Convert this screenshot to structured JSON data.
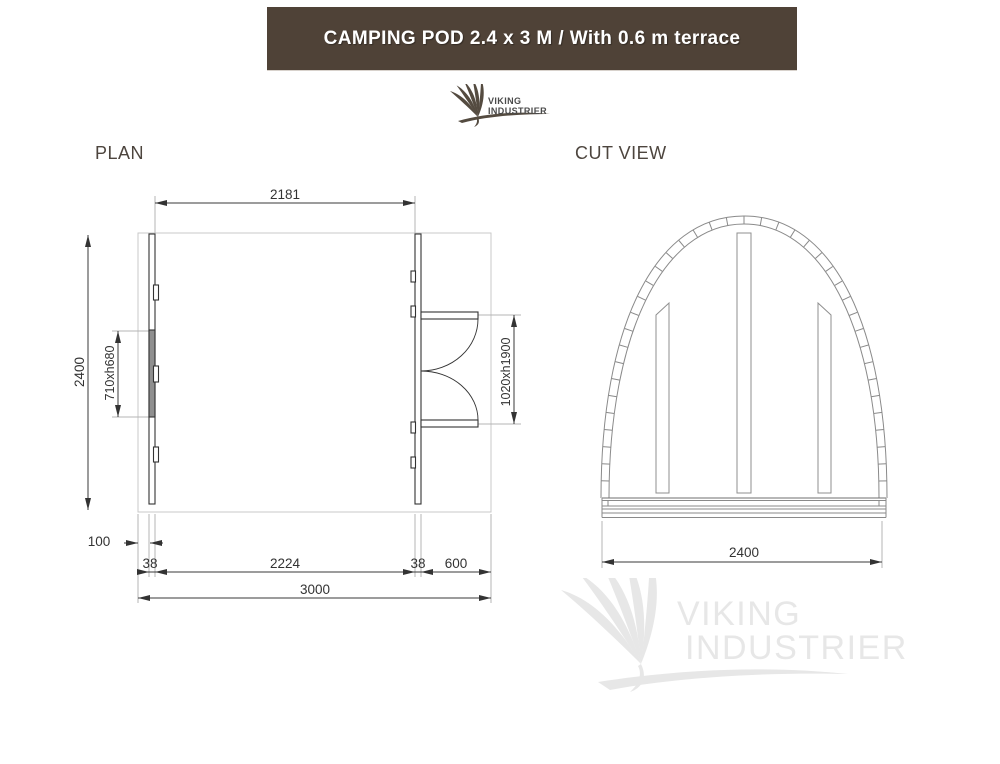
{
  "header": {
    "title": "CAMPING POD 2.4 x 3 M / With 0.6 m terrace",
    "bg_color": "#4f4237",
    "text_color": "#ffffff"
  },
  "logo": {
    "line1": "VIKING",
    "line2": "INDUSTRIER"
  },
  "watermark": {
    "line1": "VIKING",
    "line2": "INDUSTRIER",
    "color": "#e7e7e7"
  },
  "sections": {
    "plan_label": "PLAN",
    "cut_label": "CUT VIEW"
  },
  "plan_dims": {
    "inner_width": "2181",
    "depth": "2400",
    "window_opening": "710xh680",
    "door_opening": "1020xh1900",
    "side_offset": "100",
    "wall_left": "38",
    "inner_length": "2224",
    "wall_right": "38",
    "terrace": "600",
    "total_length": "3000"
  },
  "cut_dims": {
    "width": "2400"
  },
  "colors": {
    "dark_line": "#333333",
    "light_line": "#c9c9c9",
    "extension_line": "#b5b5b5",
    "cut_line": "#8a8a8a",
    "window_fill": "#8f8f8f"
  }
}
